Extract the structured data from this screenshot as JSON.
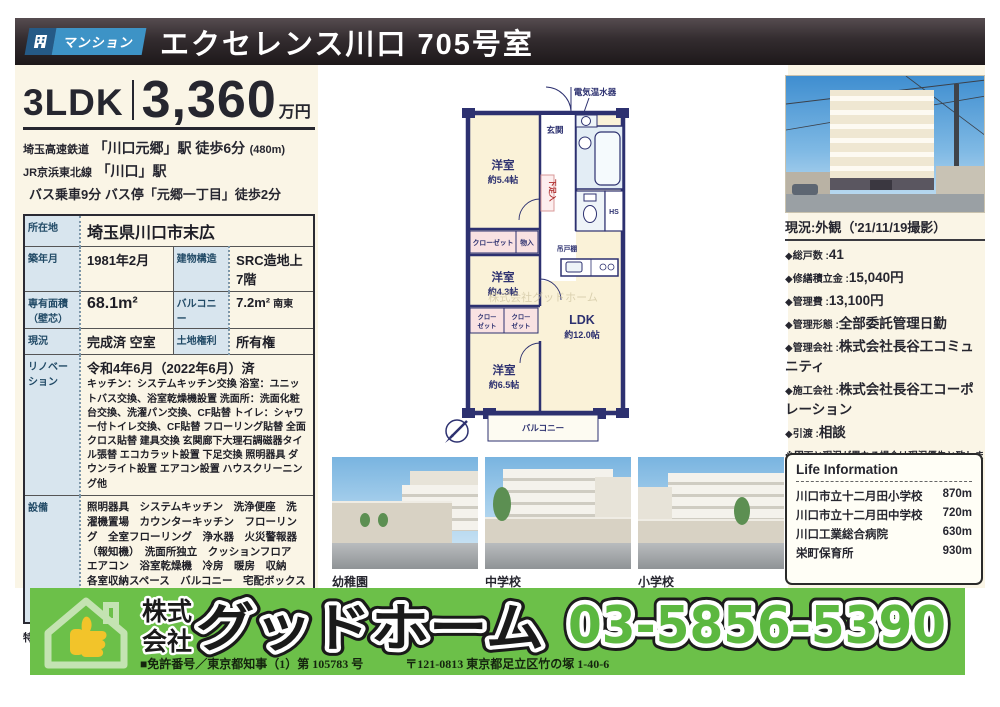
{
  "header": {
    "badge": "マンション",
    "title": "エクセレンス川口 705号室"
  },
  "summary": {
    "layout": "3LDK",
    "price": "3,360",
    "price_unit": "万円",
    "access_line1_line": "埼玉高速鉄道",
    "access_line1_main": "「川口元郷」駅 徒歩6分",
    "access_line1_note": "(480m)",
    "access_line2_line": "JR京浜東北線",
    "access_line2_main": "「川口」駅",
    "access_line3": "バス乗車9分 バス停「元郷一丁目」徒歩2分"
  },
  "spec": {
    "location_label": "所在地",
    "location": "埼玉県川口市末広",
    "built_label": "築年月",
    "built": "1981年2月",
    "structure_label": "建物構造",
    "structure": "SRC造地上7階",
    "area_label": "専有面積（壁芯）",
    "area": "68.1m²",
    "balcony_label": "バルコニー",
    "balcony": "7.2m²",
    "balcony_dir": "南東",
    "status_label": "現況",
    "status": "完成済 空室",
    "land_label": "土地権利",
    "land": "所有権",
    "reno_label": "リノベーション",
    "reno_title": "令和4年6月（2022年6月）済",
    "reno_detail": "キッチン：システムキッチン交換 浴室：ユニットバス交換、浴室乾燥機設置 洗面所：洗面化粧台交換、洗濯パン交換、CF貼替 トイレ：シャワー付トイレ交換、CF貼替 フローリング貼替 全面クロス貼替 建具交換 玄関廊下大理石調磁器タイル張替 エコカラット設置 下足交換 照明器具 ダウンライト設置 エアコン設置 ハウスクリーニング他",
    "equip_label": "設備",
    "equip": "照明器具　システムキッチン　洗浄便座　洗濯機置場　カウンターキッチン　フローリング　全室フローリング　浄水器　火災警報器（報知機）　洗面所独立　クッションフロア　エアコン　浴室乾燥機　冷房　暖房　収納　各室収納スペース　バルコニー　宅配ボックス　南面バルコニー　ペット可　陽当り良好　管理人日勤　眺望良好　複数路線利用可",
    "special": "特定事項『ペット可(1住戸2匹まで。成長時体高40cm未満)』"
  },
  "floorplan": {
    "water_heater": "電気温水器",
    "entrance": "玄関",
    "room1": "洋室",
    "room1_size": "約5.4帖",
    "closet": "クローゼット",
    "storage": "物入",
    "room2": "洋室",
    "room2_size": "約4.3帖",
    "shoe_box": "下足入",
    "hs": "HS",
    "cupboard": "吊戸棚",
    "closet2_l1": "クロー",
    "closet2_l2": "ゼット",
    "closet3_l1": "クロー",
    "closet3_l2": "ゼット",
    "room3": "洋室",
    "room3_size": "約6.5帖",
    "ldk": "LDK",
    "ldk_size": "約12.0帖",
    "balcony": "バルコニー",
    "watermark": "株式会社グッドホーム"
  },
  "photos": {
    "p1": "幼稚園",
    "p2": "中学校",
    "p3": "小学校"
  },
  "right_panel": {
    "photo_caption": "現況:外観（'21/11/19撮影）",
    "d1_label": "◆総戸数 :",
    "d1_value": "41",
    "d2_label": "◆修繕積立金 :",
    "d2_value": "15,040円",
    "d3_label": "◆管理費 :",
    "d3_value": "13,100円",
    "d4_label": "◆管理形態 :",
    "d4_value": "全部委託管理日勤",
    "d5_label": "◆管理会社 :",
    "d5_value": "株式会社長谷工コミュニティ",
    "d6_label": "◆施工会社 :",
    "d6_value": "株式会社長谷工コーポレーション",
    "d7_label": "◆引渡 :",
    "d7_value": "相談",
    "note": "※図面と現況が異なる場合は現況優先と致します。",
    "id": "ID:0595956",
    "life_title": "Life Information",
    "life1_name": "川口市立十二月田小学校",
    "life1_dist": "870m",
    "life2_name": "川口市立十二月田中学校",
    "life2_dist": "720m",
    "life3_name": "川口工業総合病院",
    "life3_dist": "630m",
    "life4_name": "栄町保育所",
    "life4_dist": "930m"
  },
  "footer": {
    "company_prefix1": "株式",
    "company_prefix2": "会社",
    "company_name": "グッドホーム",
    "phone": "03-5856-5390",
    "license": "■免許番号／東京都知事（1）第 105783 号",
    "address": "〒121-0813 東京都足立区竹の塚 1-40-6"
  },
  "colors": {
    "banner_green": "#6cc049",
    "badge_blue": "#3d93c6",
    "plan_wall_navy": "#2d3170",
    "plan_room_cream": "#faf2d8",
    "page_cream": "#faf5e6",
    "table_head_blue": "#d8e5ee"
  }
}
